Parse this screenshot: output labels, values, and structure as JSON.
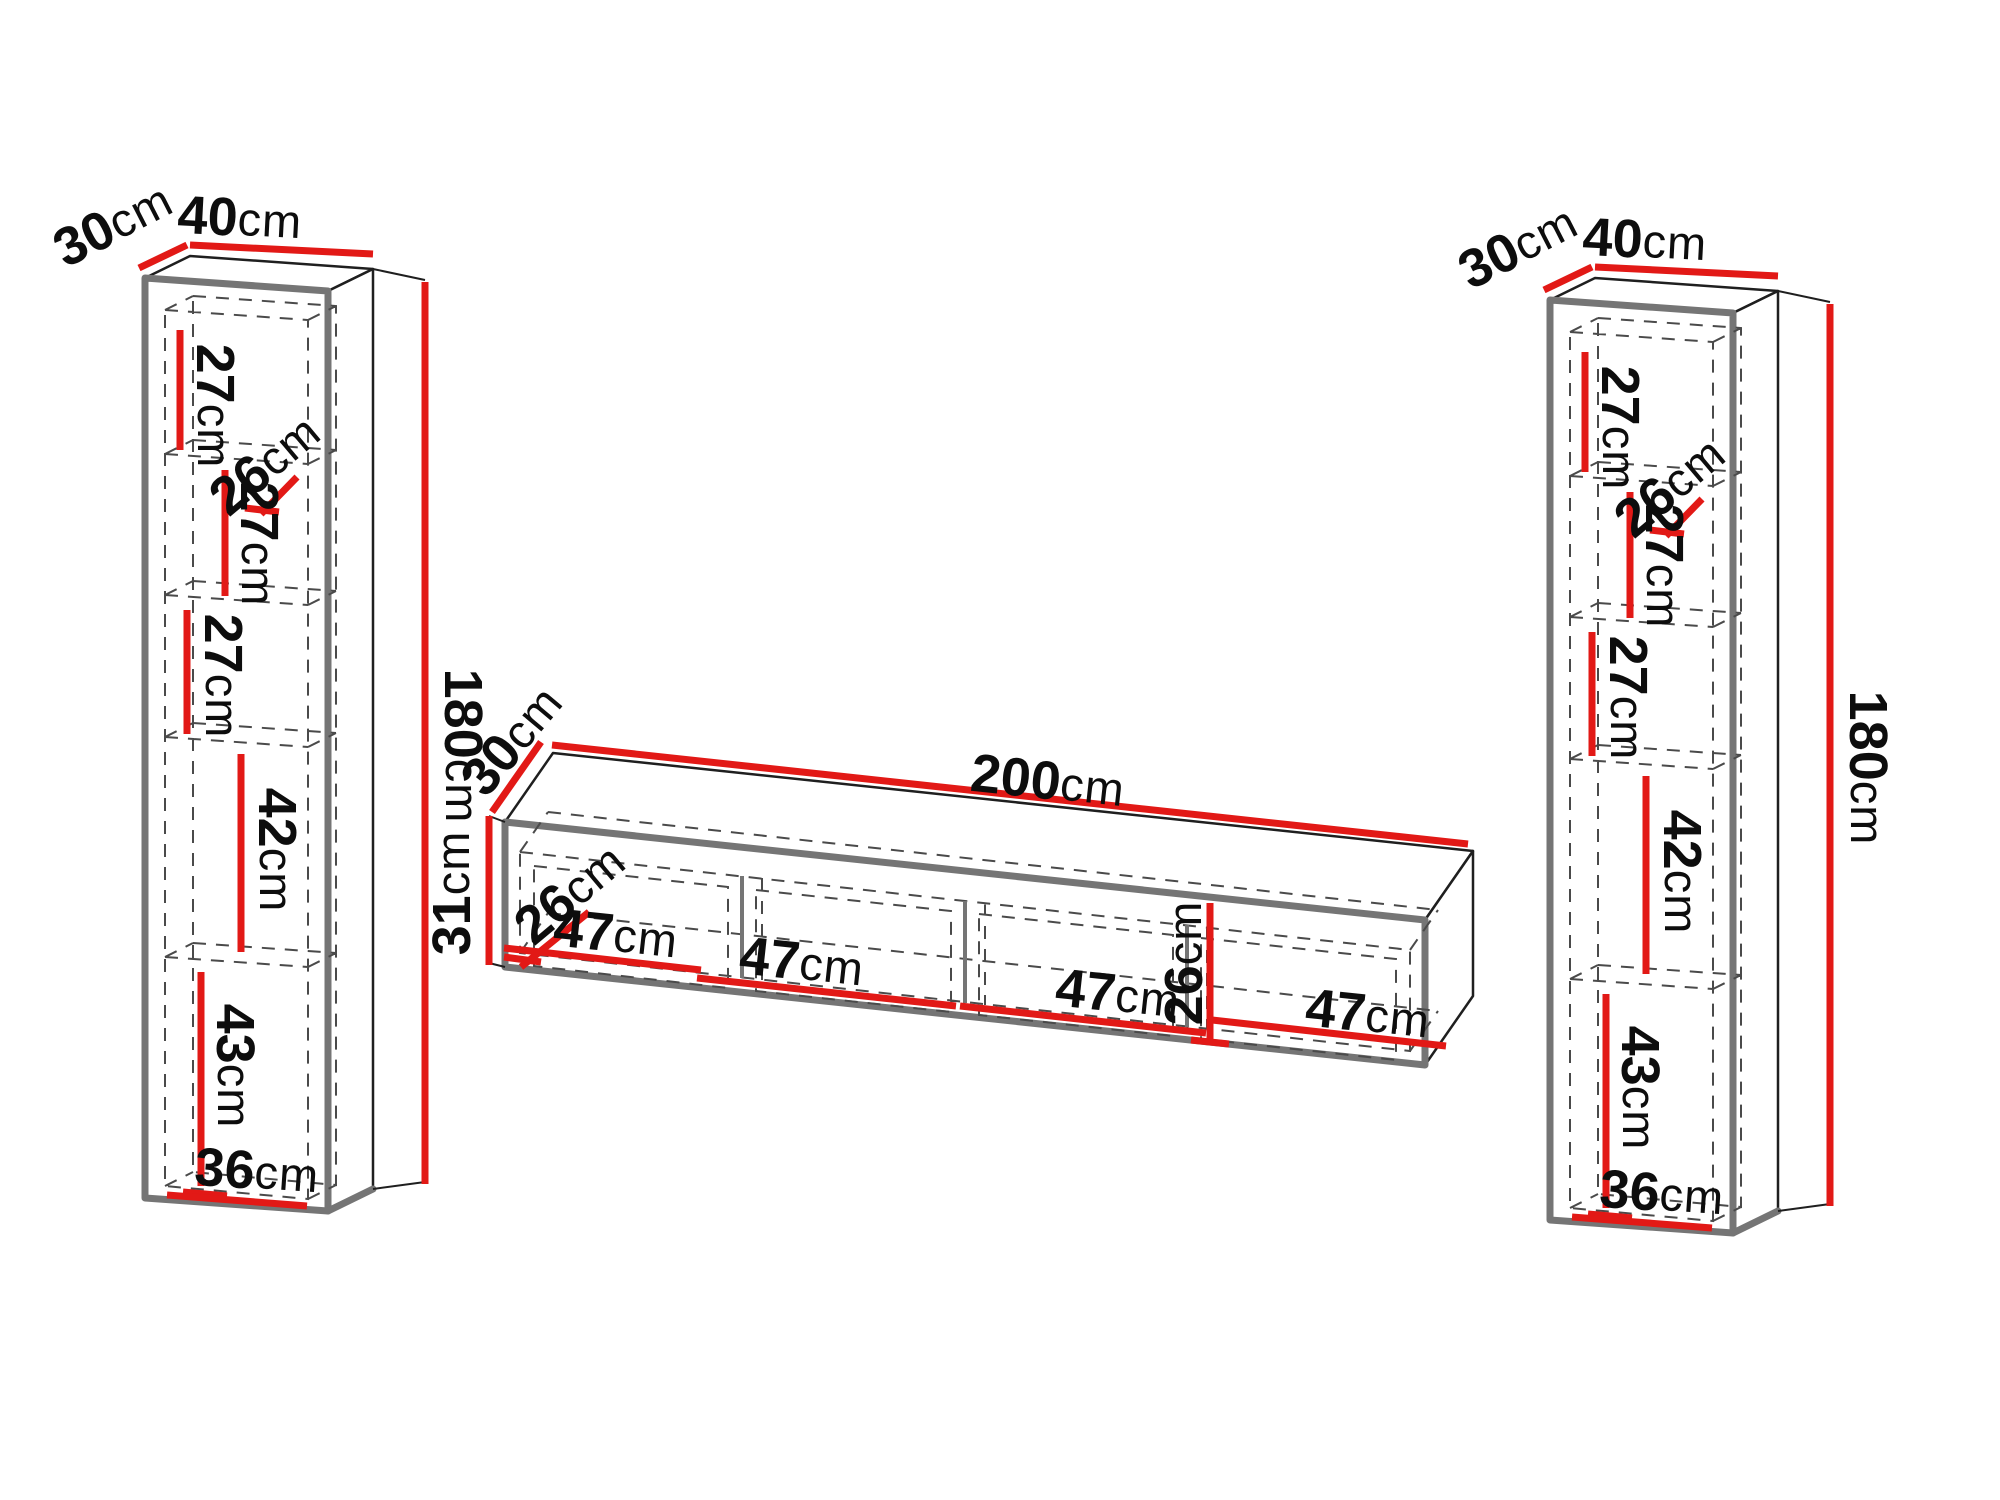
{
  "colors": {
    "dimension_red": "#e21916",
    "outline_gray": "#757575",
    "line_black": "#1f1f1f",
    "dash_gray": "#4a4a4a",
    "text_black": "#0d0d0d"
  },
  "left_cabinet": {
    "depth": {
      "v": "30",
      "u": "cm"
    },
    "width": {
      "v": "40",
      "u": "cm"
    },
    "height": {
      "v": "180",
      "u": "cm"
    },
    "shelf1": {
      "v": "27",
      "u": "cm"
    },
    "shelf_depth": {
      "v": "26",
      "u": "cm"
    },
    "shelf2": {
      "v": "27",
      "u": "cm"
    },
    "shelf3": {
      "v": "27",
      "u": "cm"
    },
    "shelf4": {
      "v": "42",
      "u": "cm"
    },
    "shelf5": {
      "v": "43",
      "u": "cm"
    },
    "inner_width": {
      "v": "36",
      "u": "cm"
    }
  },
  "tv_stand": {
    "depth": {
      "v": "30",
      "u": "cm"
    },
    "width": {
      "v": "200",
      "u": "cm"
    },
    "height": {
      "v": "31",
      "u": "cm"
    },
    "shelf_depth": {
      "v": "26",
      "u": "cm"
    },
    "inner_height": {
      "v": "26",
      "u": "cm"
    },
    "compartment1": {
      "v": "47",
      "u": "cm"
    },
    "compartment2": {
      "v": "47",
      "u": "cm"
    },
    "compartment3": {
      "v": "47",
      "u": "cm"
    },
    "compartment4": {
      "v": "47",
      "u": "cm"
    }
  },
  "right_cabinet": {
    "depth": {
      "v": "30",
      "u": "cm"
    },
    "width": {
      "v": "40",
      "u": "cm"
    },
    "height": {
      "v": "180",
      "u": "cm"
    },
    "shelf1": {
      "v": "27",
      "u": "cm"
    },
    "shelf_depth": {
      "v": "26",
      "u": "cm"
    },
    "shelf2": {
      "v": "27",
      "u": "cm"
    },
    "shelf3": {
      "v": "27",
      "u": "cm"
    },
    "shelf4": {
      "v": "42",
      "u": "cm"
    },
    "shelf5": {
      "v": "43",
      "u": "cm"
    },
    "inner_width": {
      "v": "36",
      "u": "cm"
    }
  }
}
